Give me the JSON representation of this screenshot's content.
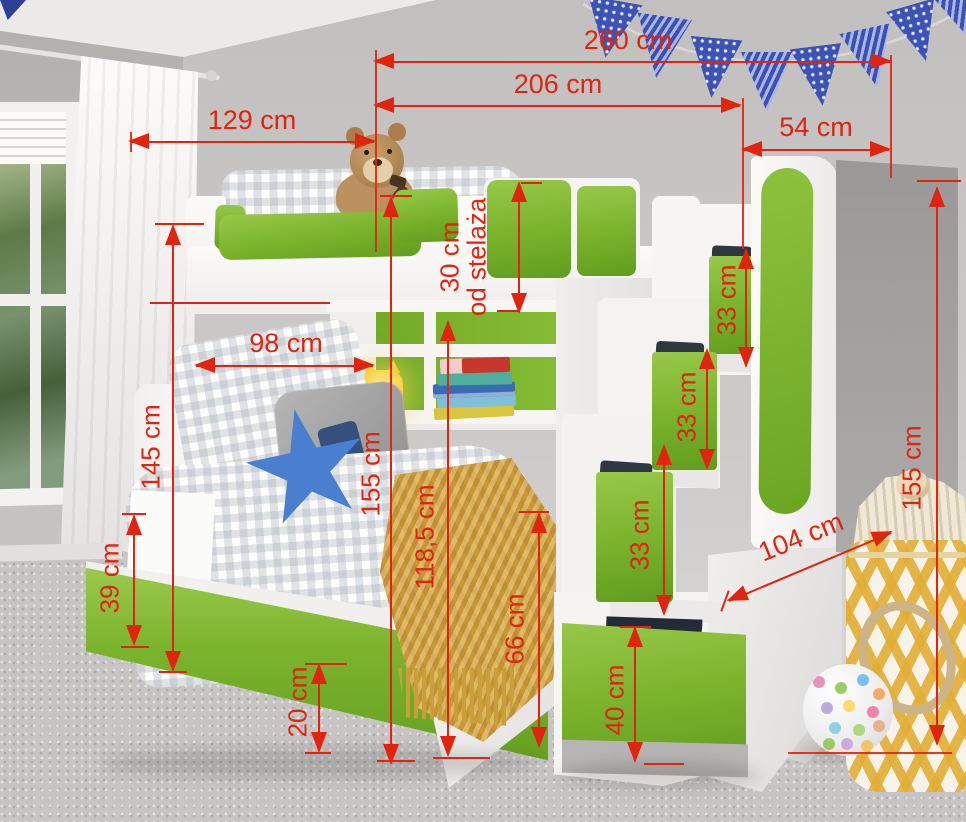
{
  "colors": {
    "annotation": "#e0240e",
    "accent_green": "#7ab32c"
  },
  "unit": "cm",
  "dimensions": {
    "total_width": {
      "label": "260 cm"
    },
    "bed_length": {
      "label": "206 cm"
    },
    "left_width": {
      "label": "129 cm"
    },
    "stairs_depth": {
      "label": "54 cm"
    },
    "rail_height": {
      "label": "30 cm",
      "suffix": "od stelaża"
    },
    "step_top": {
      "label": "33 cm"
    },
    "step_mid": {
      "label": "33 cm"
    },
    "step_low": {
      "label": "33 cm"
    },
    "shelf_width": {
      "label": "98 cm"
    },
    "headboard_height": {
      "label": "145 cm"
    },
    "platform_height": {
      "label": "155 cm"
    },
    "underbed_height": {
      "label": "118,5 cm"
    },
    "footboard_height": {
      "label": "66 cm"
    },
    "trundle_front_height": {
      "label": "39 cm"
    },
    "trundle_clearance": {
      "label": "20 cm"
    },
    "stairs_length": {
      "label": "104 cm"
    },
    "stairs_height": {
      "label": "155 cm"
    },
    "bottom_drawer_height": {
      "label": "40 cm"
    }
  }
}
